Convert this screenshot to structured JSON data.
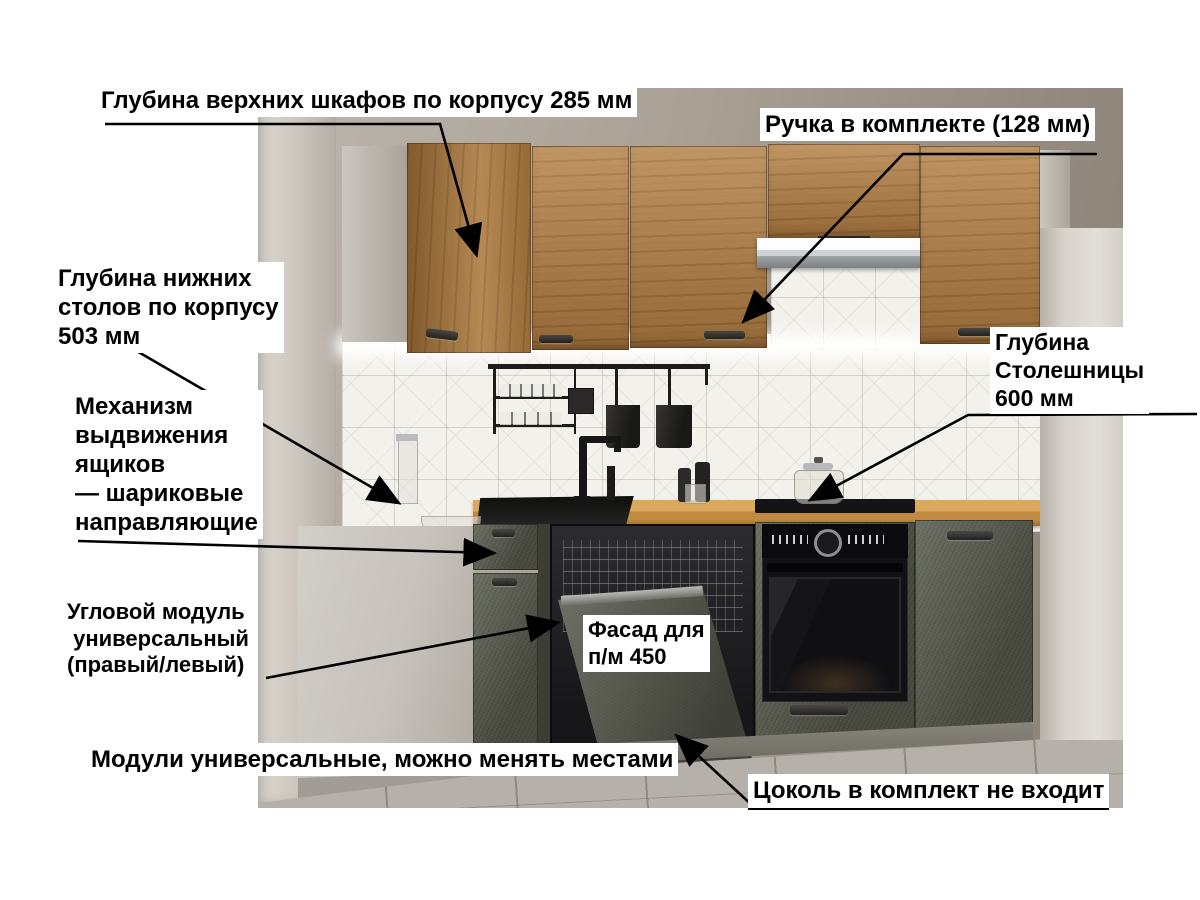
{
  "annotations": {
    "upper_cabinet_depth": "Глубина верхних шкафов по корпусу 285 мм",
    "handle_included": "Ручка в комплекте (128 мм)",
    "base_cabinet_depth": "Глубина нижних\nстолов по корпусу\n503 мм",
    "drawer_mechanism": "Механизм\nвыдвижения\nящиков\n— шариковые\nнаправляющие",
    "countertop_depth": "Глубина\nСтолешницы\n600 мм",
    "corner_module": "Угловой модуль\n универсальный\n(правый/левый)",
    "dishwasher_facade": "Фасад для\nп/м 450",
    "universal_modules": "Модули универсальные, можно менять местами",
    "plinth_note": "Цоколь в комплект не входит"
  },
  "colors": {
    "annotation_text": "#000000",
    "annotation_bg": "#ffffff",
    "arrow": "#000000",
    "upper_cabinet_wood": "#ab7b45",
    "base_cabinet_green": "#5c5f52",
    "countertop_wood": "#c8974f",
    "wall": "#a8a095",
    "backsplash_tile": "#f3f1ec",
    "floor": "#b5b1aa"
  }
}
